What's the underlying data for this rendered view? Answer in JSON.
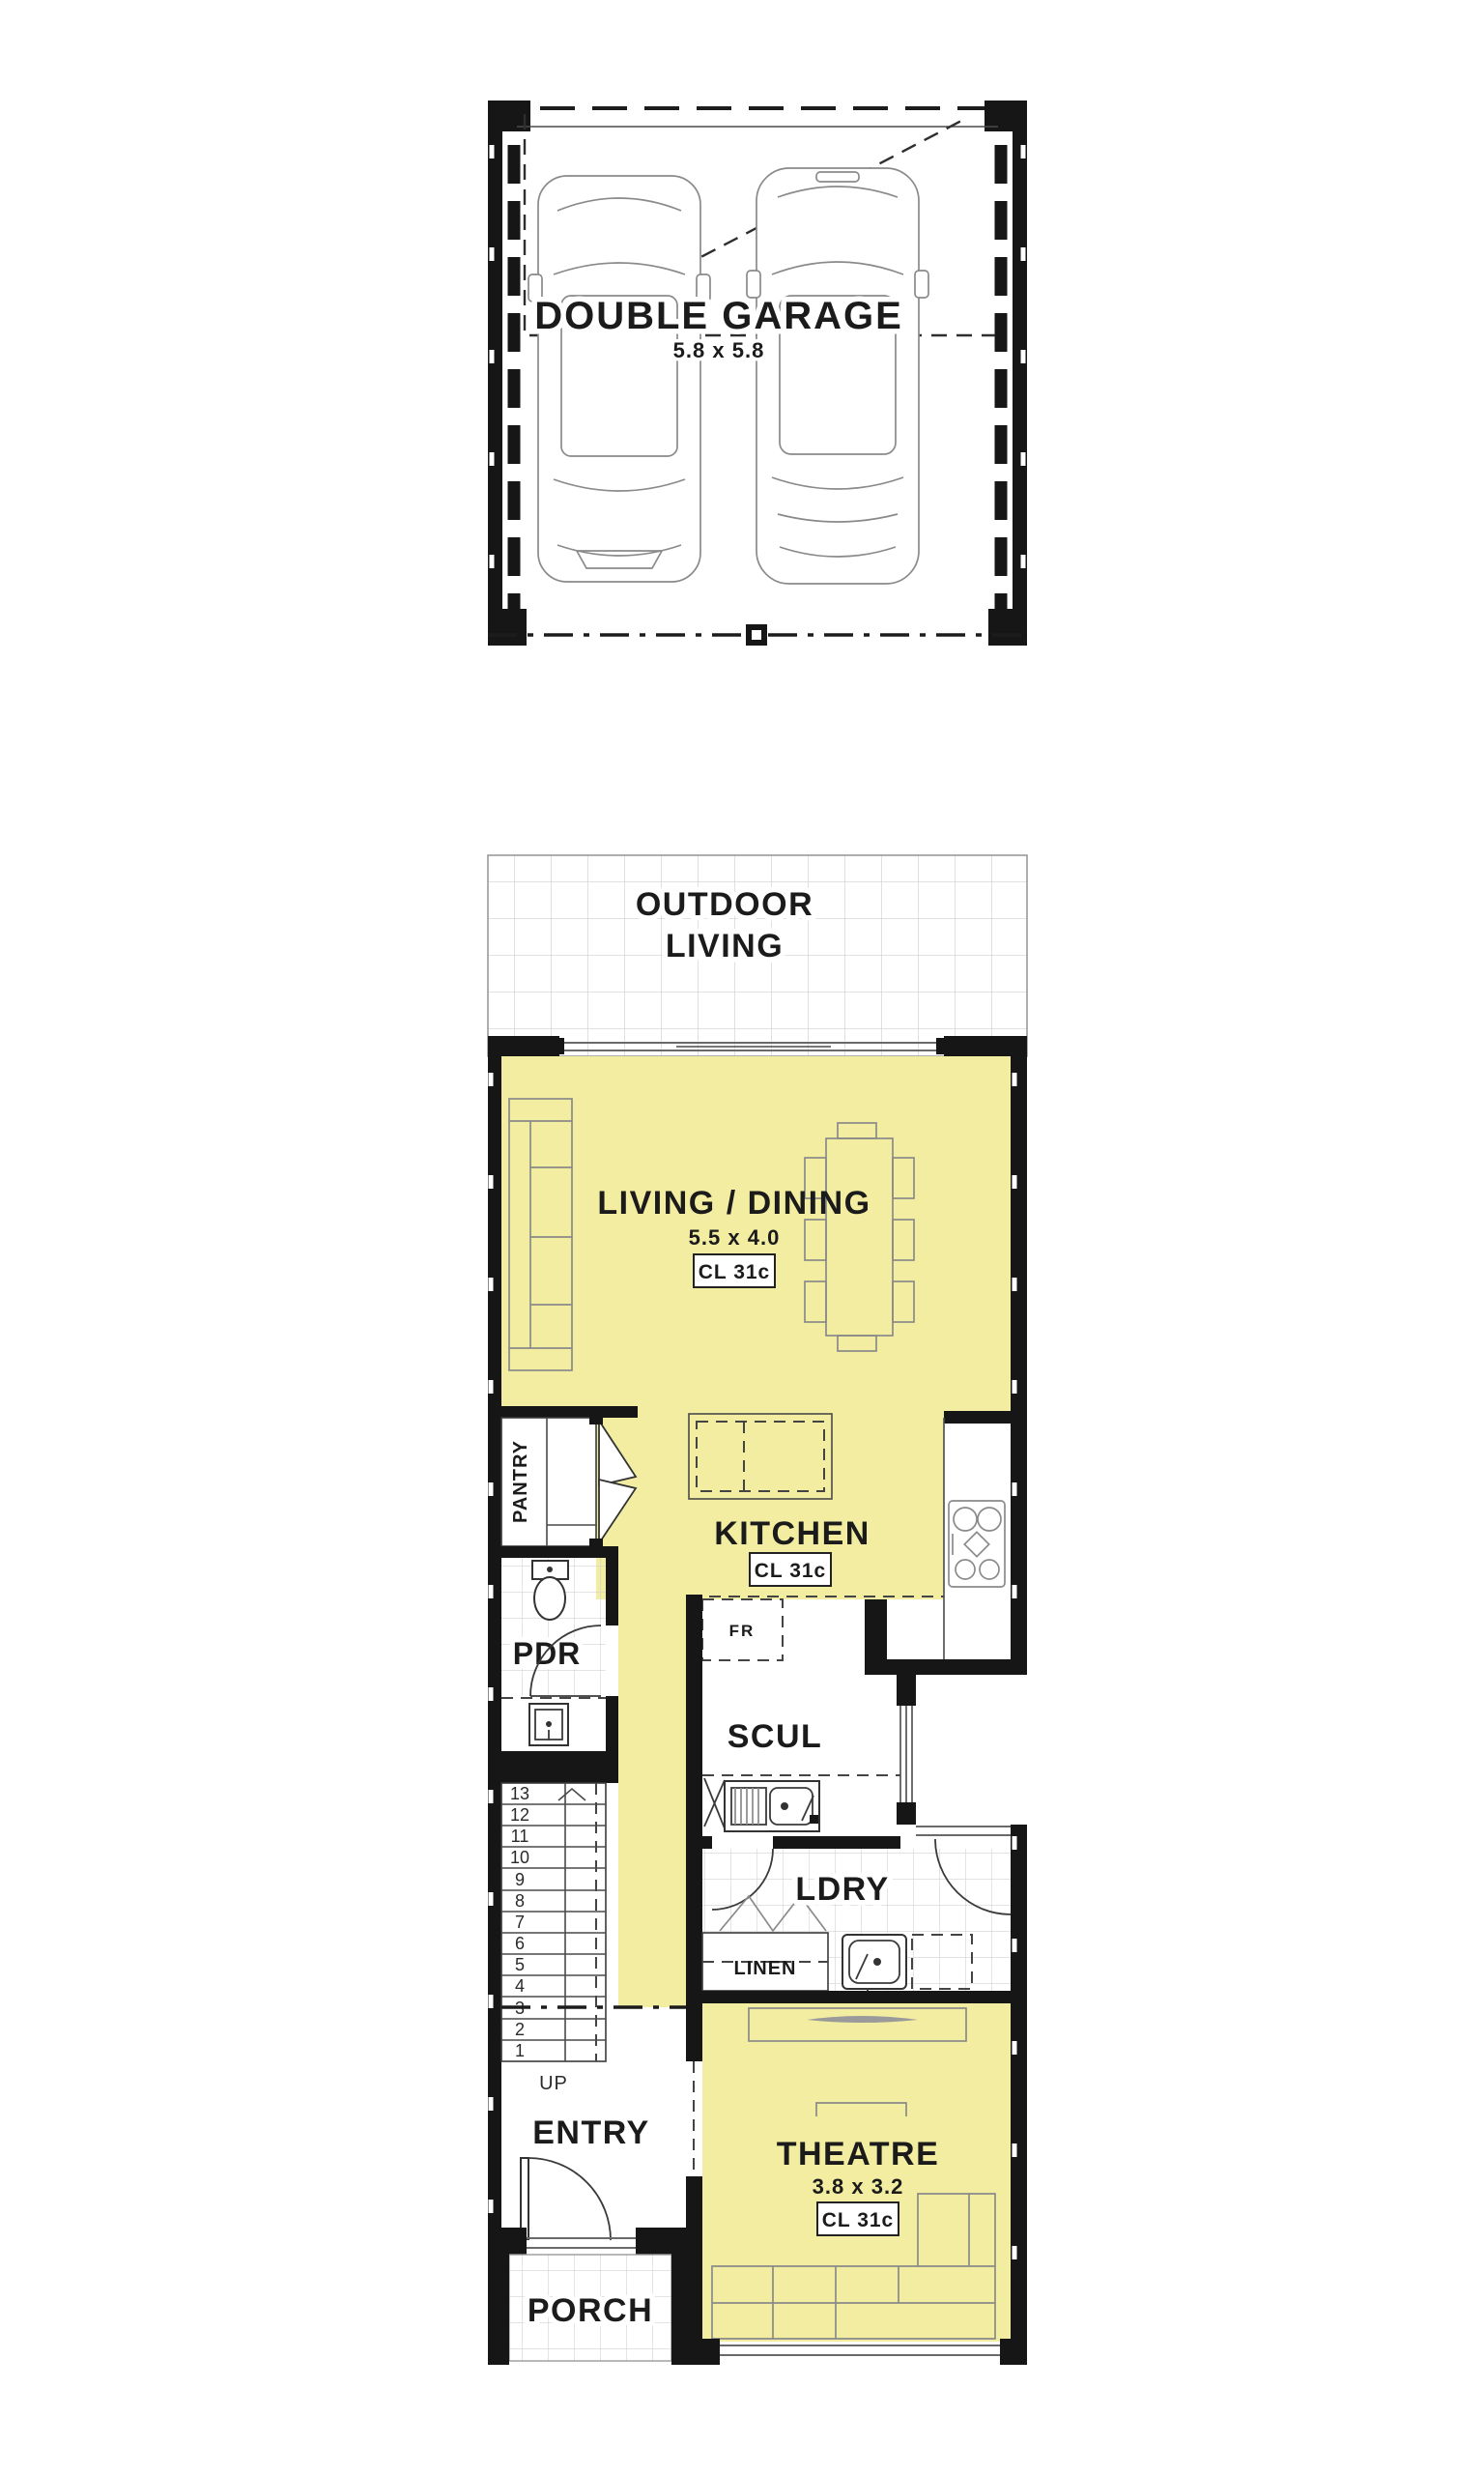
{
  "colors": {
    "room_fill": "#f3eda1",
    "wall": "#161616",
    "tile_line": "#cfcfcf",
    "furniture_line": "#8a8a8a",
    "text": "#1b1b1b"
  },
  "garage": {
    "label": "DOUBLE GARAGE",
    "dims": "5.8 x 5.8"
  },
  "outdoor_living": {
    "line1": "OUTDOOR",
    "line2": "LIVING"
  },
  "living_dining": {
    "label": "LIVING / DINING",
    "dims": "5.5 x 4.0",
    "cl": "CL 31c"
  },
  "kitchen": {
    "label": "KITCHEN",
    "cl": "CL 31c",
    "fridge": "FR",
    "pantry": "PANTRY"
  },
  "pdr": {
    "label": "PDR"
  },
  "scullery": {
    "label": "SCUL"
  },
  "laundry": {
    "label": "LDRY",
    "linen": "LINEN"
  },
  "stairs": {
    "up": "UP",
    "treads": [
      "13",
      "12",
      "11",
      "10",
      "9",
      "8",
      "7",
      "6",
      "5",
      "4",
      "3",
      "2",
      "1"
    ]
  },
  "entry": {
    "label": "ENTRY"
  },
  "theatre": {
    "label": "THEATRE",
    "dims": "3.8 x 3.2",
    "cl": "CL 31c"
  },
  "porch": {
    "label": "PORCH"
  }
}
